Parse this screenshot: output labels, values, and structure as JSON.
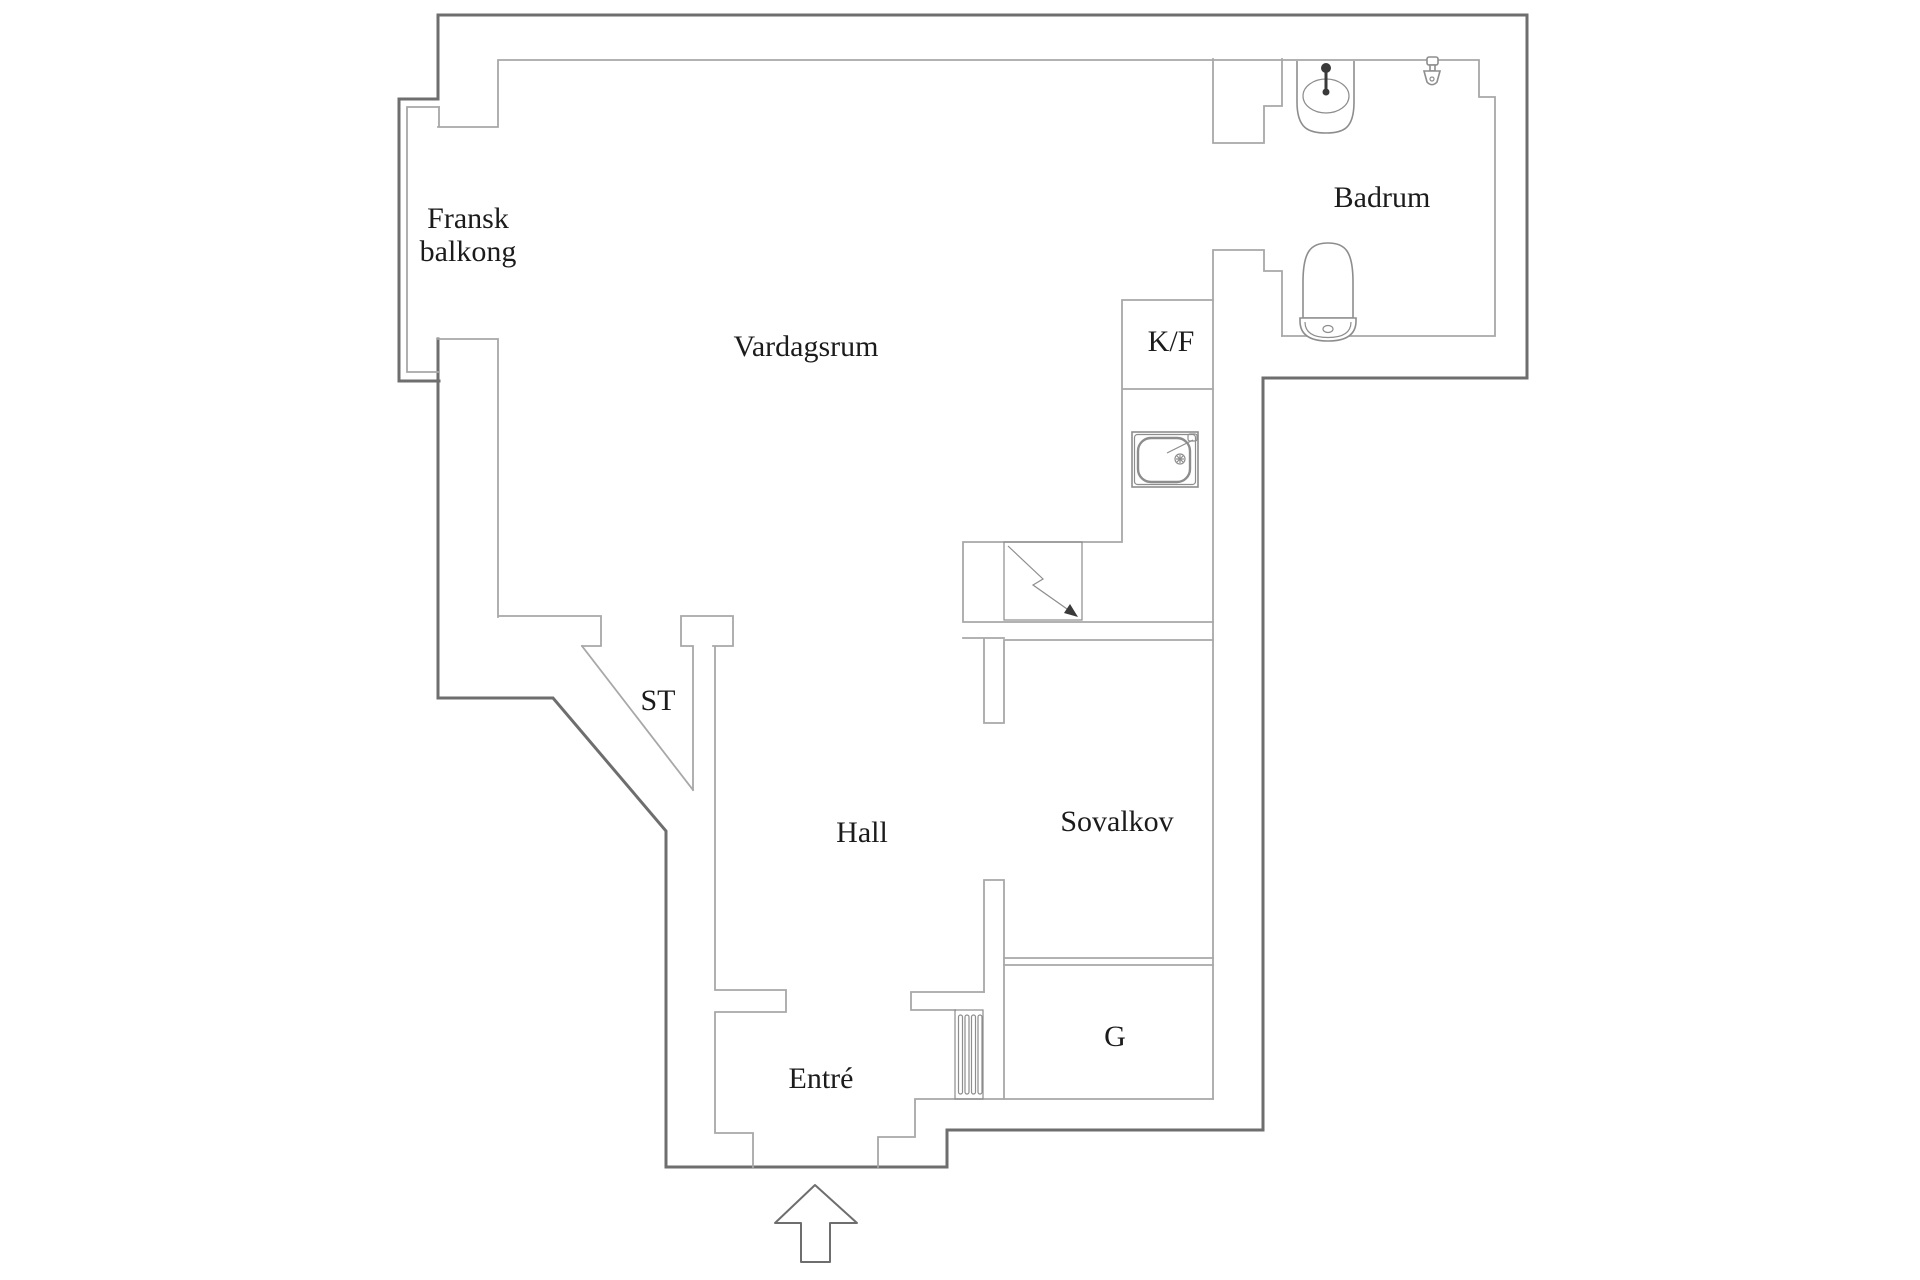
{
  "title": "Apartment floor plan",
  "colors": {
    "background": "#ffffff",
    "wall_dark": "#6e6e6e",
    "wall_light": "#a8a8a8",
    "fixture": "#8d8d8d",
    "fixture_dark": "#3a3a3a",
    "text": "#1b1b1b"
  },
  "labels": {
    "fransk_balkong_line1": "Fransk",
    "fransk_balkong_line2": "balkong",
    "vardagsrum": "Vardagsrum",
    "badrum": "Badrum",
    "kf": "K/F",
    "st": "ST",
    "hall": "Hall",
    "sovalkov": "Sovalkov",
    "entre": "Entré",
    "garderob": "G"
  },
  "fixtures": [
    {
      "name": "bathroom-sink-icon",
      "room": "Badrum"
    },
    {
      "name": "shower-icon",
      "room": "Badrum"
    },
    {
      "name": "toilet-icon",
      "room": "Badrum"
    },
    {
      "name": "fridge-freezer-box",
      "room": "kitchen",
      "label": "K/F"
    },
    {
      "name": "kitchen-sink-icon",
      "room": "kitchen"
    },
    {
      "name": "electrical-panel-icon",
      "room": "kitchen"
    },
    {
      "name": "closet-door-swing",
      "room": "ST"
    },
    {
      "name": "radiator-icon",
      "room": "Entré"
    },
    {
      "name": "entrance-arrow-icon",
      "room": "Entré"
    }
  ]
}
